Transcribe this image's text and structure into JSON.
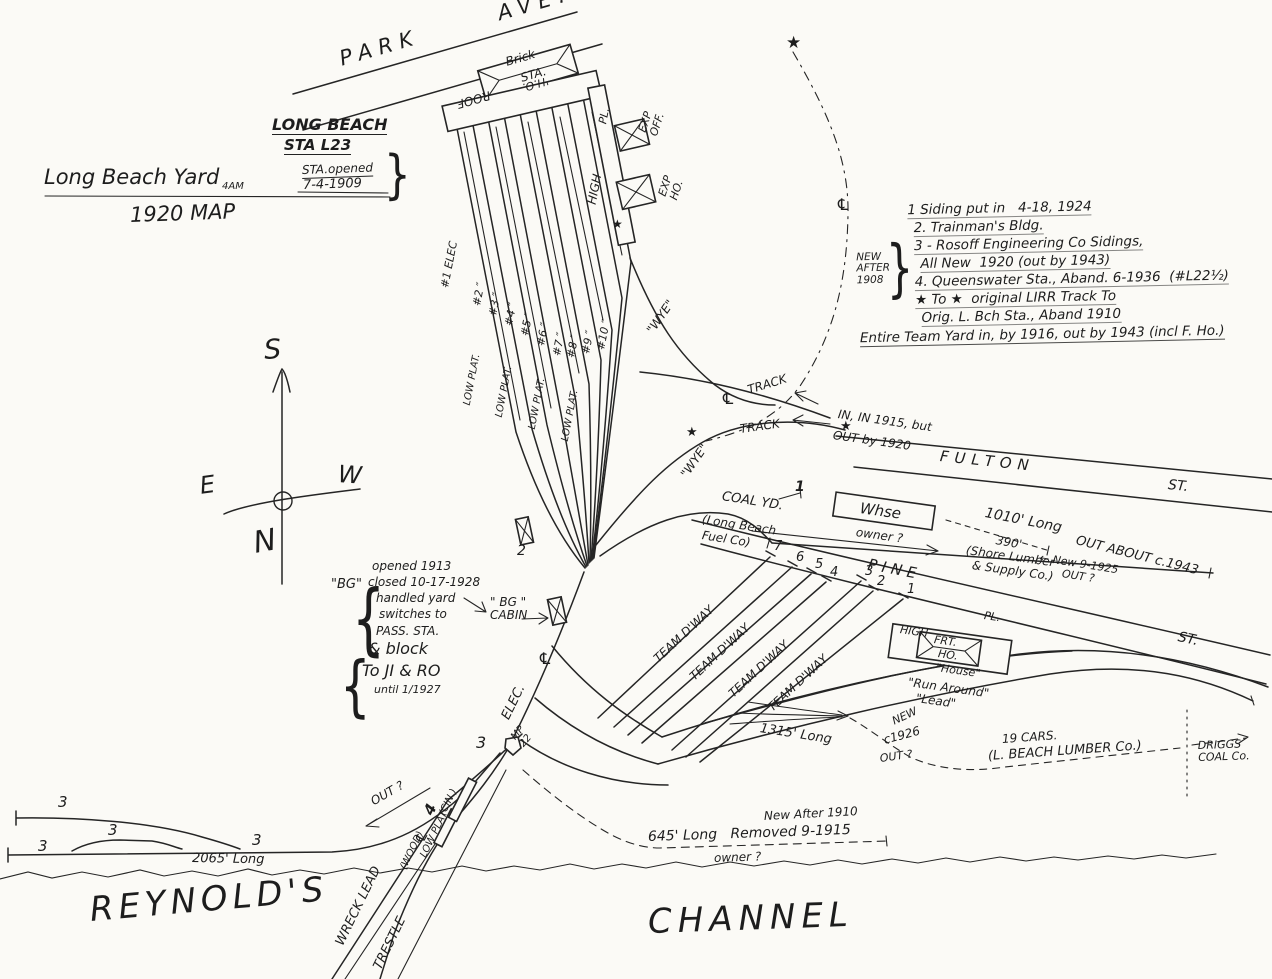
{
  "colors": {
    "paper": "#fbfaf6",
    "ink": "#252525"
  },
  "streets": {
    "park_ave": "PARK      AVE.",
    "fulton": "FULTON",
    "pine": "PINE",
    "st": "ST."
  },
  "title": {
    "station_name": "LONG BEACH",
    "station_no": "STA L23",
    "yard": "Long Beach Yard",
    "initials": "4AM",
    "opened": "STA.opened",
    "opened_date": "7-4-1909",
    "brace": "}",
    "map": "1920 MAP"
  },
  "notes": {
    "side": "NEW\nAFTER\n1908",
    "brace": "}",
    "items": [
      "1 Siding put in   4-18, 1924",
      "2. Trainman's Bldg.",
      "3 - Rosoff Engineering Co Sidings,",
      "All New  1920 (out by 1943)",
      "4. Queenswater Sta., Aband. 6-1936  (#L22½)",
      "★ To ★  original LIRR Track To",
      "Orig. L. Bch Sta., Aband 1910",
      "Entire Team Yard in, by 1916, out by 1943 (incl F. Ho.)"
    ]
  },
  "compass": {
    "n": "N",
    "s": "S",
    "e": "E",
    "w": "W"
  },
  "station": {
    "brick": "Brick",
    "sta": "STA.",
    "roof": "ROOF",
    "ho": "'H.O.",
    "pl": "PL.",
    "high": "HIGH",
    "exp_off": "EXP\nOFF.",
    "exp_ho": "EXP\nHO.",
    "low_plat": "LOW PLAT.",
    "tracks": [
      "#1 ELEC",
      "#2 ″",
      "#3 ″",
      "#4 ″",
      "#5 ″",
      "#6 ″",
      "#7 ″",
      "#8 ″",
      "#9 ″",
      "#10 ″"
    ]
  },
  "wye": {
    "label": "\"WYE\""
  },
  "fulton": {
    "track": "TRACK",
    "in_1915": "IN, IN 1915, but",
    "out_1920": "OUT by 1920"
  },
  "coal": {
    "coal_yd": "COAL YD.",
    "marker": "1",
    "fuel_1": "(Long Beach",
    "fuel_2": "Fuel Co)",
    "whse": "Whse",
    "owner": "owner ?",
    "len_1010": "1010' Long",
    "out_about": "OUT ABOUT c.1943",
    "len_390": "390'",
    "new_9_1925": "← New 9-1925",
    "shore_1": "(Shore Lumber",
    "shore_2": "& Supply Co.)"
  },
  "team": {
    "dway": "TEAM D'WAY",
    "numbers": [
      "7",
      "6",
      "5",
      "4",
      "3",
      "2",
      "1"
    ]
  },
  "freight": {
    "frt": "FRT.",
    "ho": "HO.",
    "house": "\"House\"",
    "run_around": "\"Run Around\"",
    "lead": "\"Lead\""
  },
  "south": {
    "len_1315": "1315' Long",
    "new_lbl": "NEW",
    "c_1926": "c1926",
    "cars": "19 CARS.",
    "lumber": "(L. BEACH LUMBER Co.)",
    "driggs": "DRIGGS\nCOAL Co.",
    "elec": "ELEC.",
    "mp": "MP\n22",
    "three": "3",
    "len_2065": "2065' Long",
    "len_645": "645' Long   Removed 9-1915",
    "new_after_1910": "New After 1910"
  },
  "trestle": {
    "wreck": "WRECK LEAD",
    "trestle": "TRESTLE",
    "wood": "(WOOD)",
    "low_plat": "LOW PLAT",
    "cin": "(CIN.)",
    "four": "4"
  },
  "channel": {
    "reynolds": "REYNOLD'S",
    "channel": "CHANNEL"
  },
  "bg": {
    "quote": "\"BG\"",
    "brace": "{",
    "lines": [
      "opened 1913",
      "closed 10-17-1928",
      "handled yard",
      "switches to",
      "PASS. STA."
    ],
    "block": [
      "& block",
      "To JI & RO",
      "until 1/1927"
    ],
    "cabin": "\" BG \"\nCABIN"
  },
  "markers": {
    "star": "★",
    "centerline": "℄",
    "two": "2"
  },
  "misc": {
    "out_q": "OUT ?"
  }
}
